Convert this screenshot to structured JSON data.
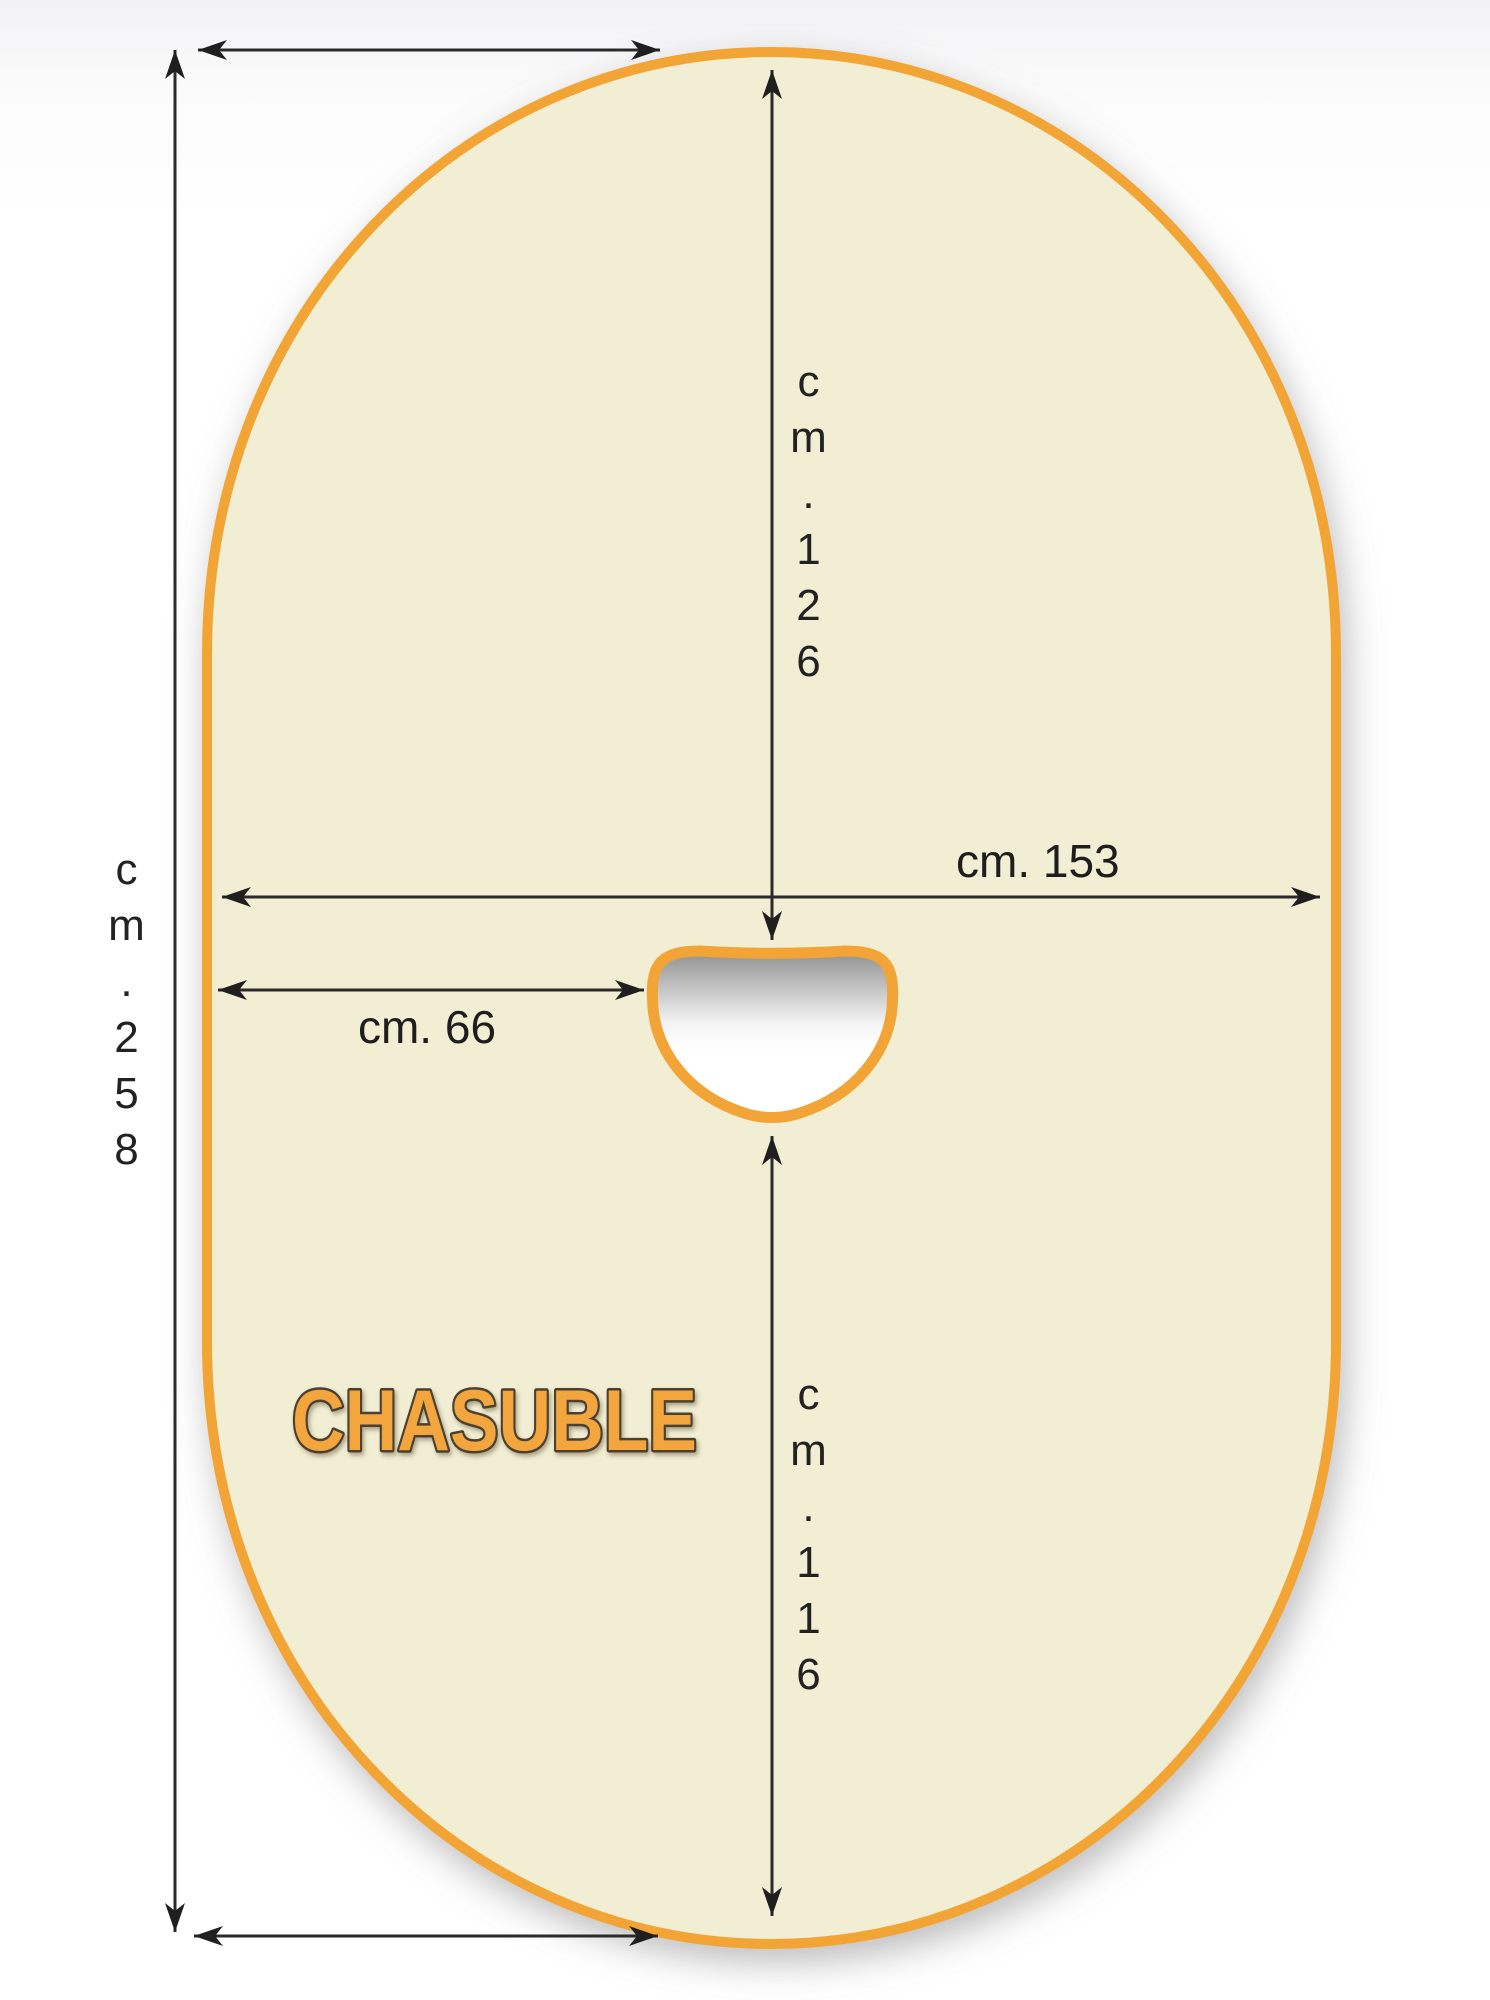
{
  "diagram": {
    "title": "Chasuble sewing pattern",
    "pattern_name": "CHASUBLE"
  },
  "dimensions": {
    "total_height": {
      "label": "cm. 258",
      "orientation": "vertical",
      "position": "left-outside"
    },
    "top_to_neck": {
      "label": "cm. 126",
      "orientation": "vertical",
      "position": "center-upper"
    },
    "width": {
      "label": "cm. 153",
      "orientation": "horizontal",
      "position": "middle"
    },
    "neck_offset": {
      "label": "cm. 66",
      "orientation": "horizontal",
      "position": "left-of-neck"
    },
    "neck_to_hem": {
      "label": "cm. 116",
      "orientation": "vertical",
      "position": "center-lower"
    }
  },
  "colors": {
    "fabric_fill": "#F1EED3",
    "outline_orange": "#F2A436",
    "dimension_line": "#2b2b2b",
    "label_text": "#1e1e1e",
    "pattern_name_fill": "#F2A63C",
    "pattern_name_outline": "#4B4133",
    "neck_shadow": "#8F8F8F",
    "background": "#FFFFFF"
  }
}
